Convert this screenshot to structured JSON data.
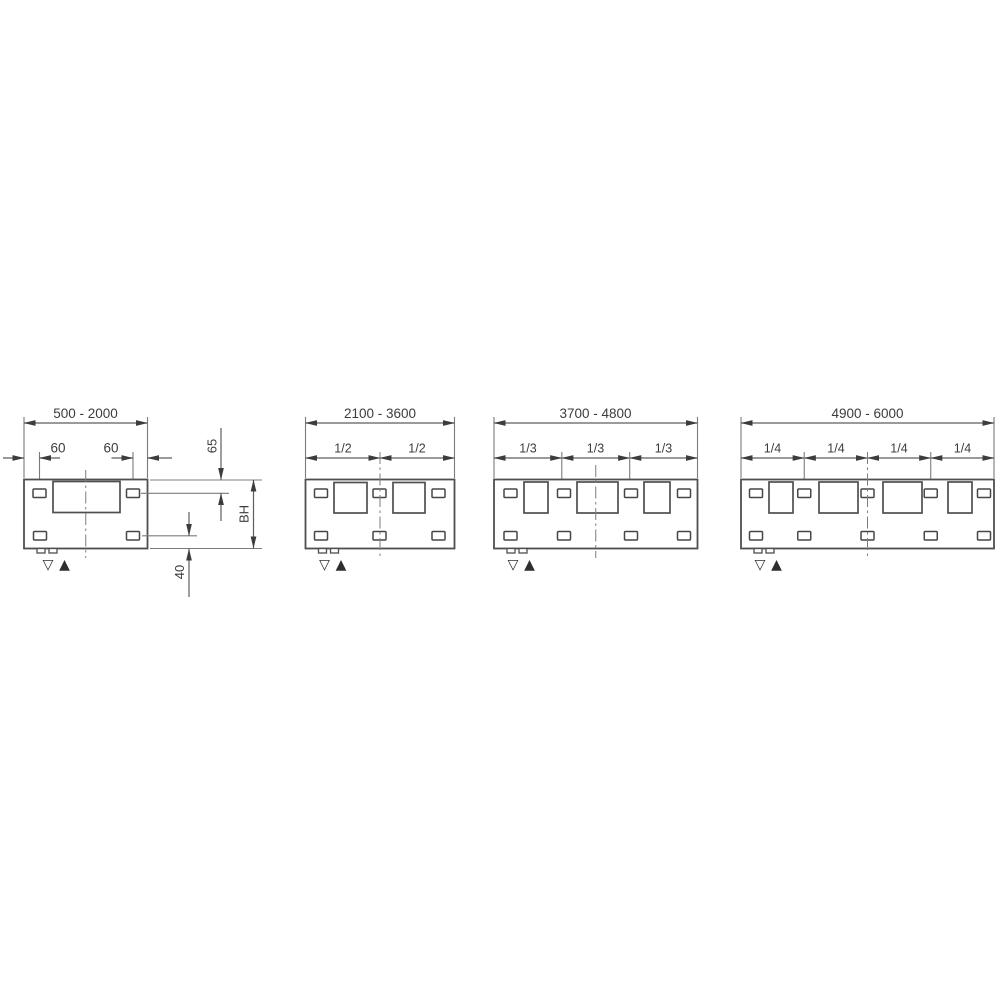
{
  "diagram": {
    "kind": "front-panel mounting dimension drawing",
    "panels": [
      {
        "width_range": "500 - 2000",
        "dims": {
          "offset_left": "60",
          "offset_right": "60",
          "top_offset": "65",
          "height": "BH",
          "bottom_offset": "40"
        }
      },
      {
        "width_range": "2100 - 3600",
        "fractions": [
          "1/2",
          "1/2"
        ]
      },
      {
        "width_range": "3700 - 4800",
        "fractions": [
          "1/3",
          "1/3",
          "1/3"
        ]
      },
      {
        "width_range": "4900 - 6000",
        "fractions": [
          "1/4",
          "1/4",
          "1/4",
          "1/4"
        ]
      }
    ],
    "symbols": {
      "open_down_triangle": "▽",
      "filled_up_triangle": "▲"
    },
    "colors": {
      "outline": "#4f4f4f",
      "dimension_line": "#5d5d5d",
      "extension_line": "#7b7b7b",
      "text": "#3c3c3c",
      "background": "#ffffff"
    }
  }
}
